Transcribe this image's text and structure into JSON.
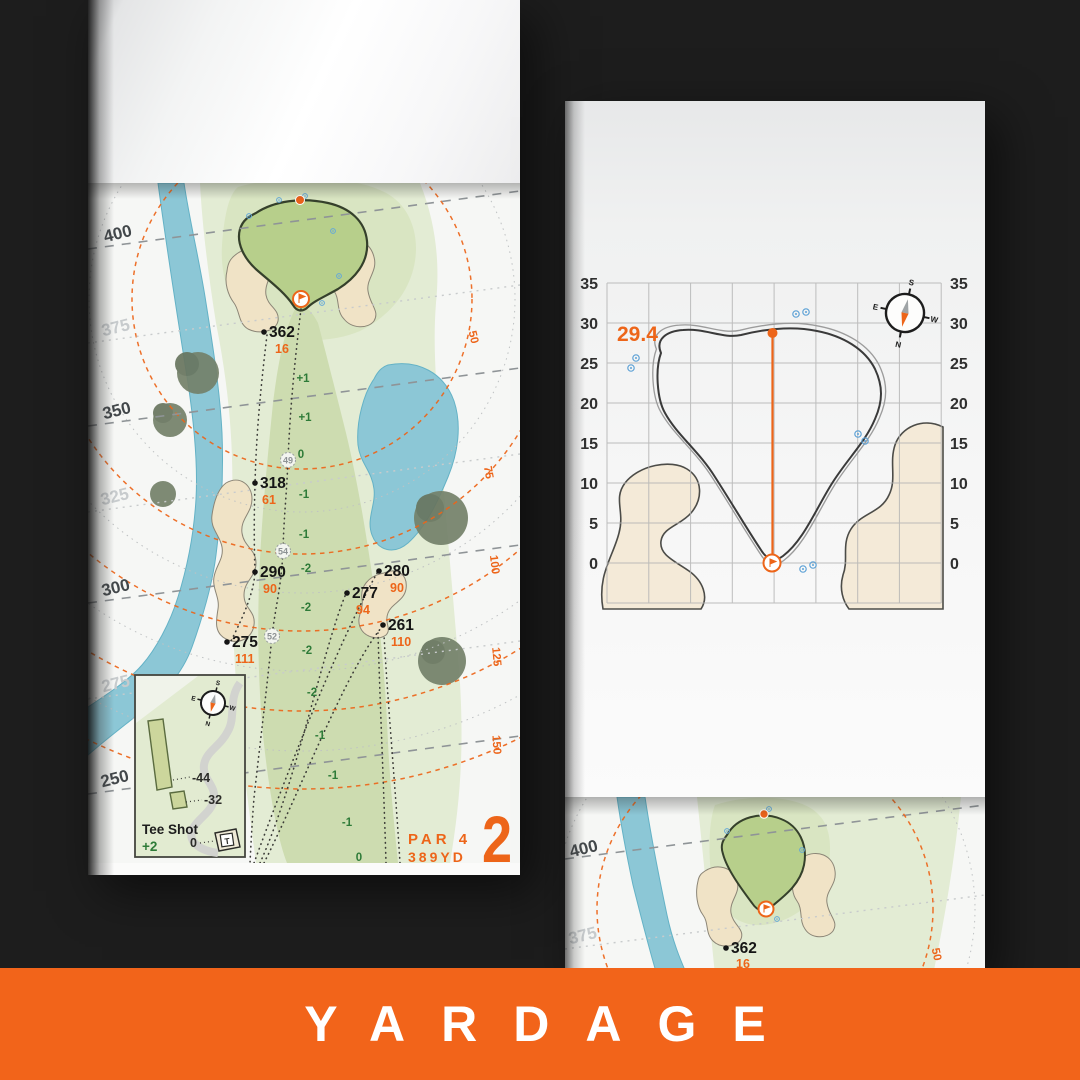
{
  "banner": {
    "label": "YARDAGE",
    "bg": "#f2641a"
  },
  "colors": {
    "accent_orange": "#ed6519",
    "banner_orange": "#f2641a",
    "water_blue": "#8cc7d6",
    "sand": "#f0e3c6",
    "green_turf": "#b7cf8b",
    "elevation_green": "#2e7b38",
    "background": "#1d1d1d"
  },
  "compass": {
    "n": "N",
    "s": "S",
    "e": "E",
    "w": "W"
  },
  "left_page": {
    "hole": {
      "number": "2",
      "par": "PAR 4",
      "yardage": "389YD"
    },
    "distance_markers": [
      {
        "label": "400",
        "shade": "dark"
      },
      {
        "label": "375",
        "shade": "light"
      },
      {
        "label": "350",
        "shade": "dark"
      },
      {
        "label": "325",
        "shade": "light"
      },
      {
        "label": "300",
        "shade": "dark"
      },
      {
        "label": "275",
        "shade": "light"
      },
      {
        "label": "250",
        "shade": "dark"
      }
    ],
    "ring_labels": [
      "50",
      "75",
      "100",
      "125",
      "150"
    ],
    "targets": [
      {
        "distance": "362",
        "carry": "16"
      },
      {
        "distance": "318",
        "carry": "61"
      },
      {
        "distance": "290",
        "carry": "90"
      },
      {
        "distance": "275",
        "carry": "111"
      },
      {
        "distance": "280",
        "carry": "90"
      },
      {
        "distance": "277",
        "carry": "94"
      },
      {
        "distance": "261",
        "carry": "110"
      }
    ],
    "elevation_profile": [
      "+1",
      "+1",
      "0",
      "-1",
      "-1",
      "-2",
      "-2",
      "-2",
      "-2",
      "-1",
      "-1",
      "-1",
      "0"
    ],
    "fairway_widths": [
      "49",
      "54",
      "52"
    ],
    "inset": {
      "title": "Tee Shot",
      "score": "+2",
      "tee_distance": "0",
      "tee_label": "T",
      "carry_labels": [
        "-44",
        "-32"
      ]
    }
  },
  "green_page": {
    "depth": "29.4",
    "axis_ticks": [
      "35",
      "30",
      "25",
      "20",
      "15",
      "10",
      "5",
      "0"
    ],
    "grid": {
      "y_min": 0,
      "y_max": 35,
      "tick_step": 5
    }
  },
  "next_page": {
    "distance_markers": [
      "400",
      "375"
    ],
    "target": {
      "distance": "362",
      "carry": "16"
    },
    "ring_label": "50"
  }
}
